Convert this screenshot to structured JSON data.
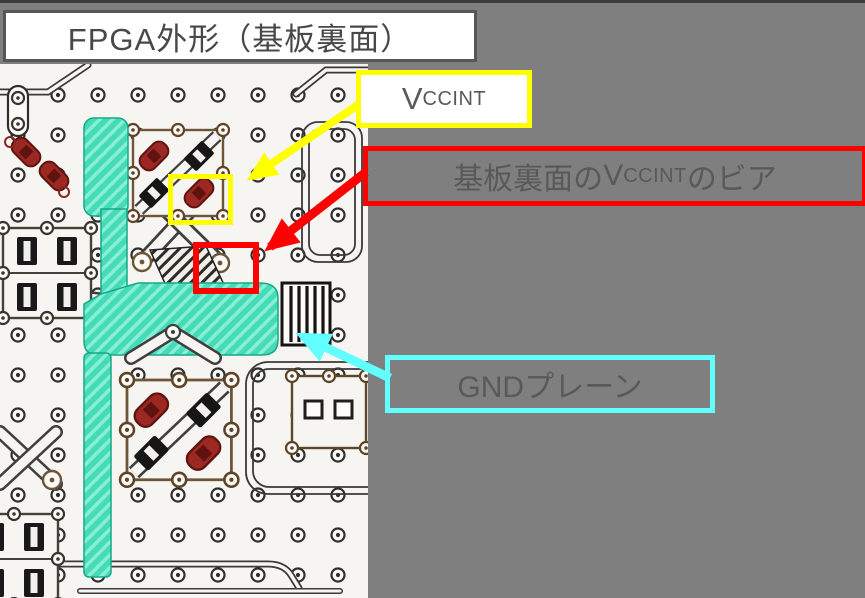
{
  "title": "FPGA外形（基板裏面）",
  "labels": {
    "vccint": {
      "cap": "V",
      "small": "CCINT"
    },
    "via": {
      "prefix": "基板裏面の",
      "cap": "V",
      "small": "CCINT",
      "suffix": "のビア"
    },
    "gnd": "GNDプレーン"
  },
  "colors": {
    "background": "#7f7f7f",
    "title_text": "#484848",
    "label_text": "#595959",
    "vccint_highlight": "#ffff00",
    "via_highlight": "#fe0000",
    "gnd_highlight": "#62ffff",
    "gnd_plane": "#44dcb6",
    "pcb_base": "#f7f5f1",
    "copper_pad": "#9b2822"
  }
}
